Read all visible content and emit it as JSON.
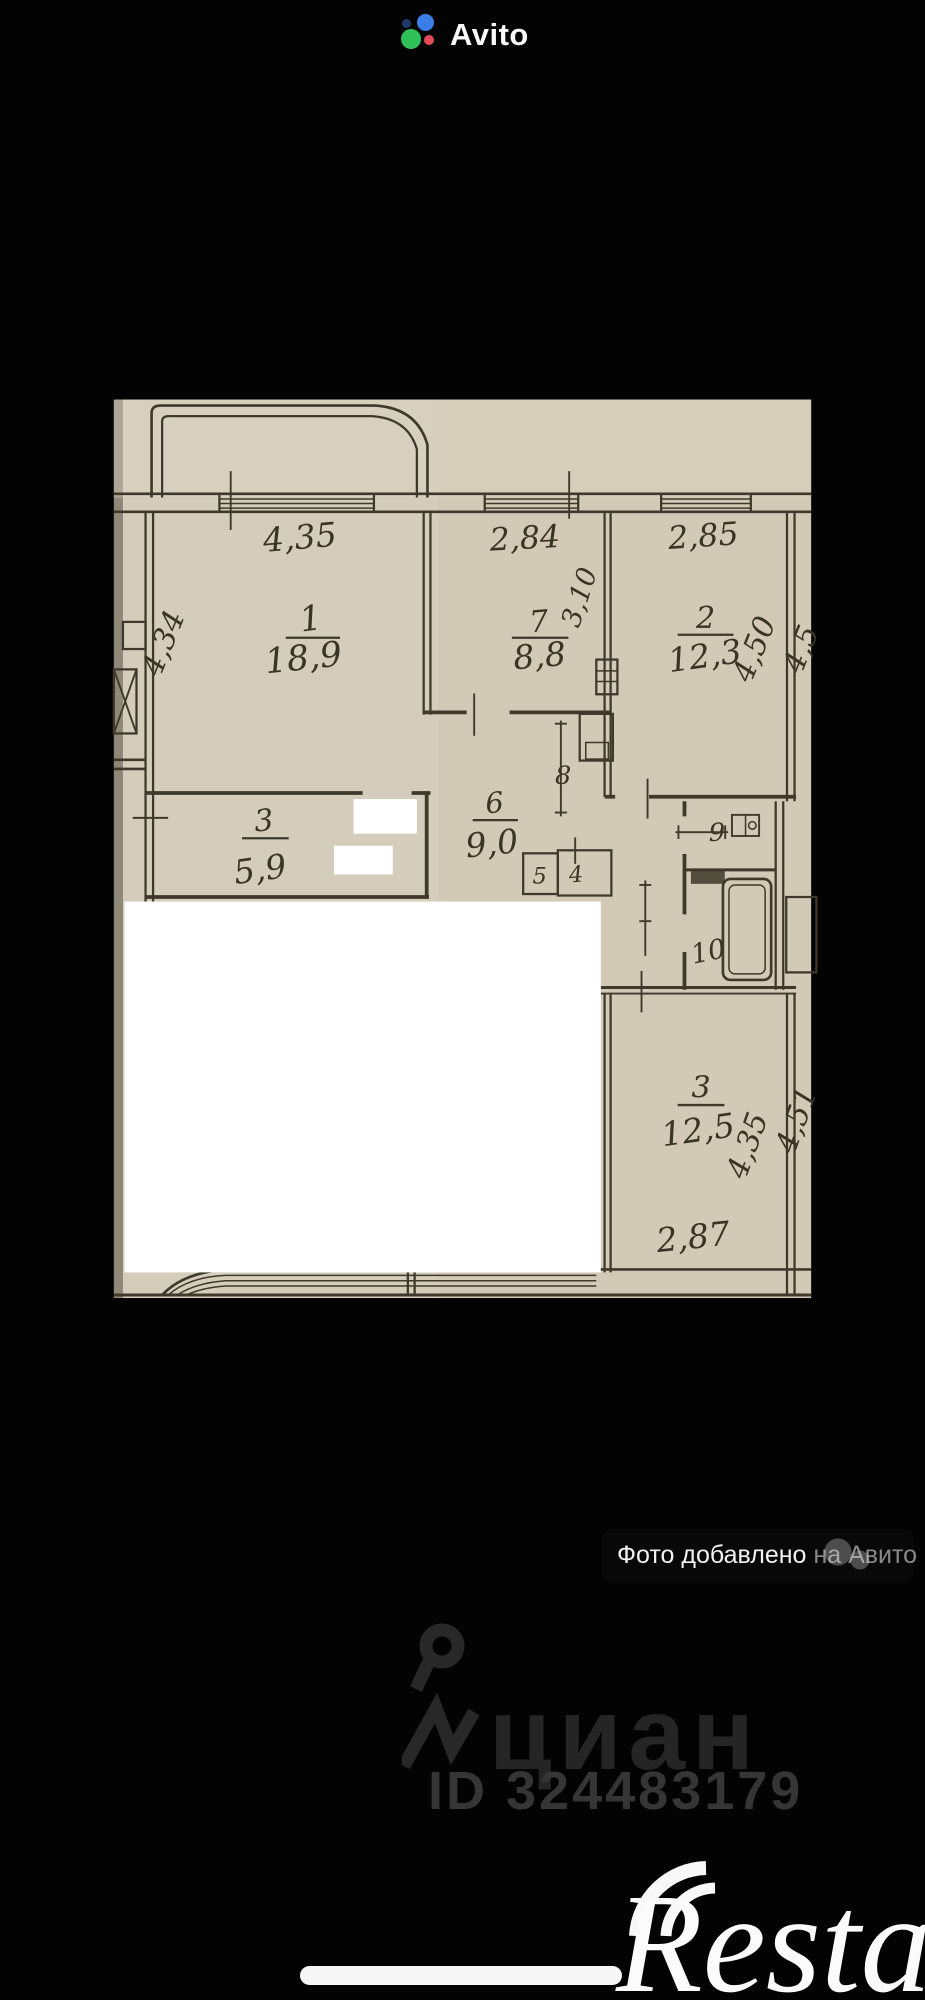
{
  "app": {
    "top_logo_text": "Avito"
  },
  "floorplan": {
    "paper_color": "#d5cdbb",
    "ink_color": "#3e392a",
    "rooms": [
      {
        "number": "1",
        "area": "18,9",
        "width_m": "4,35",
        "depth_m": "4,34",
        "type": "living-room"
      },
      {
        "number": "7",
        "area": "8,8",
        "width_m": "2,84",
        "depth_m": "3,10",
        "type": "room"
      },
      {
        "number": "2",
        "area": "12,3",
        "width_m": "2,85",
        "depth_m": "4,50",
        "type": "room"
      },
      {
        "number": "3",
        "area": "5,9",
        "type": "hallway"
      },
      {
        "number": "6",
        "area": "9,0",
        "type": "corridor"
      },
      {
        "number": "8",
        "type": "closet"
      },
      {
        "number": "5",
        "type": "closet"
      },
      {
        "number": "4",
        "type": "closet"
      },
      {
        "number": "9",
        "type": "wc"
      },
      {
        "number": "10",
        "type": "bathroom"
      },
      {
        "number": "3",
        "area": "12,5",
        "width_m": "2,87",
        "depth_m_a": "4,35",
        "depth_m_b": "4,51",
        "type": "room"
      }
    ],
    "labels": {
      "r1_num": "1",
      "r1_area": "18,9",
      "r1_w": "4,35",
      "r1_h": "4,34",
      "r7_num": "7",
      "r7_area": "8,8",
      "r7_w": "2,84",
      "r7_h": "3,10",
      "r2_num": "2",
      "r2_area": "12,3",
      "r2_w": "2,85",
      "r2_h": "4,50",
      "r2_h_cut": "4,5",
      "hall_num": "3",
      "hall_area": "5,9",
      "corr_num": "6",
      "corr_area": "9,0",
      "c8": "8",
      "c5": "5",
      "c4": "4",
      "wc": "9",
      "bath": "10",
      "r3_num": "3",
      "r3_area": "12,5",
      "r3_h1": "4,35",
      "r3_h2": "4,51",
      "r3_w": "2,87"
    },
    "photo_badge": {
      "main": "Фото добавлено",
      "ghost": "на Авито"
    }
  },
  "watermarks": {
    "cian_logo": "циан",
    "cian_id": "ID 324483179",
    "restate_logo": "Restate"
  }
}
